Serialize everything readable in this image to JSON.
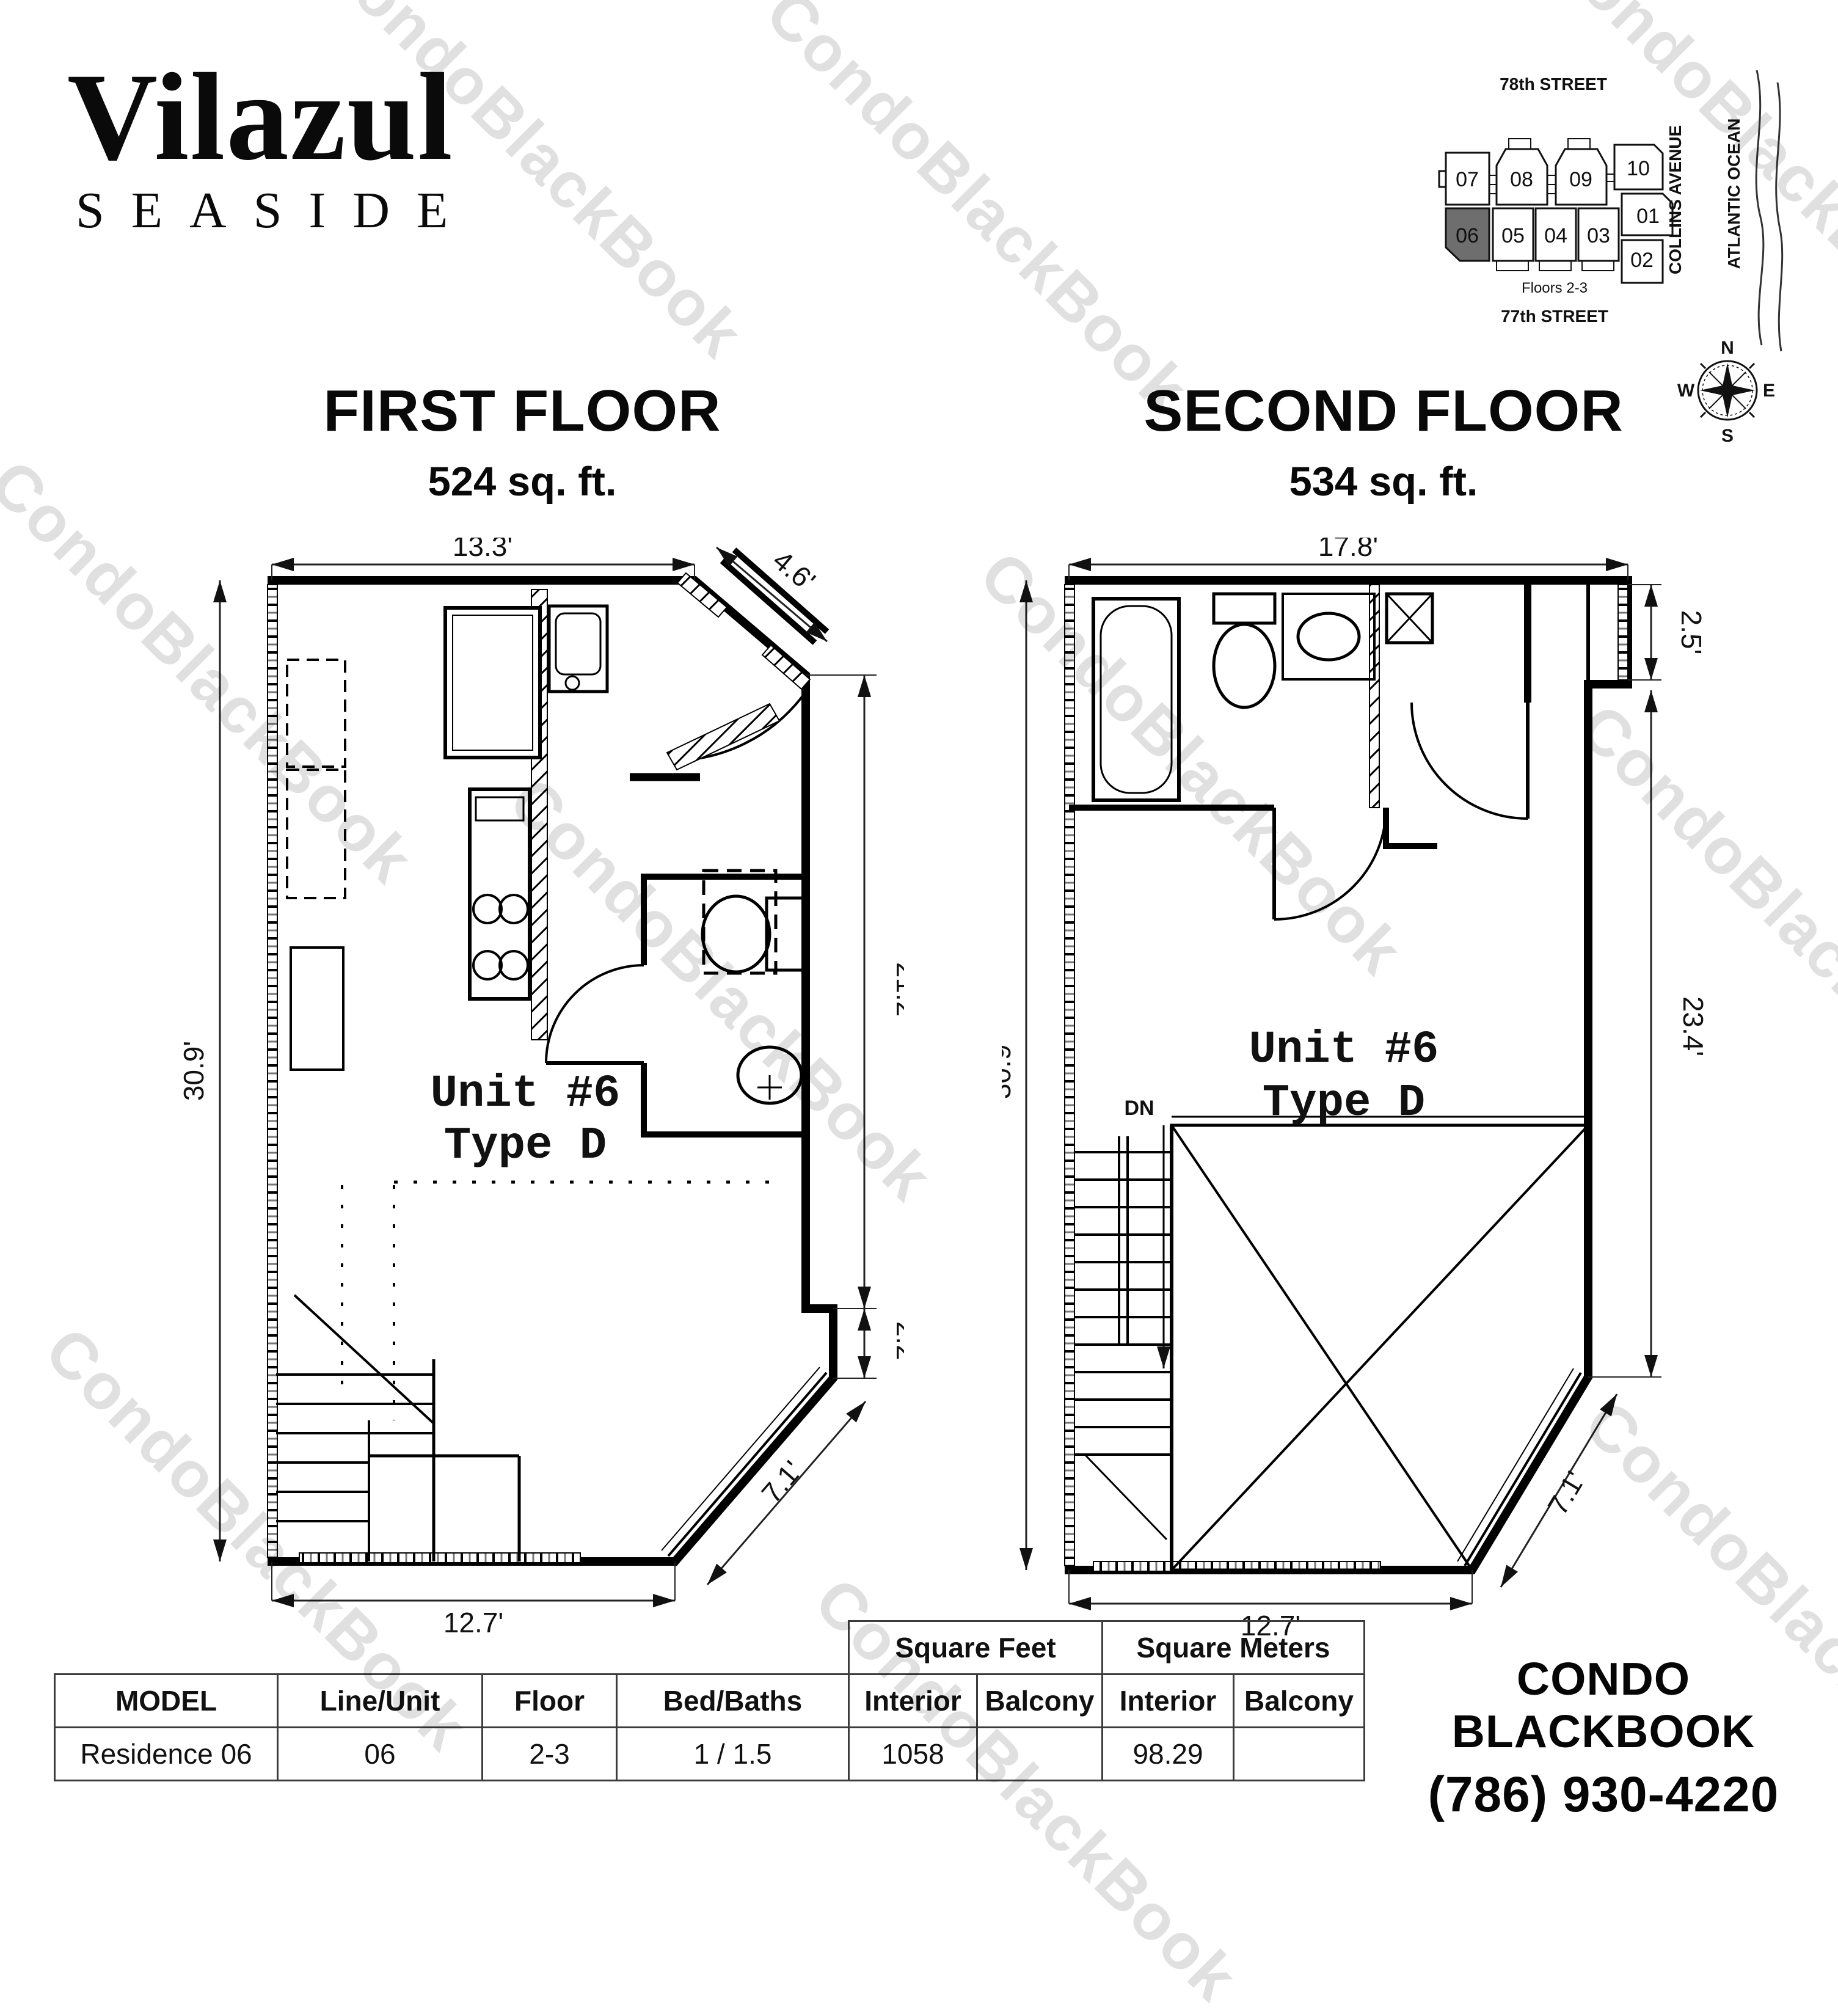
{
  "branding": {
    "logo_line1": "Vilazul",
    "logo_line2": "SEASIDE"
  },
  "site_map": {
    "street_top": "78th STREET",
    "street_bottom": "77th STREET",
    "avenue": "COLLINS AVENUE",
    "ocean": "ATLANTIC OCEAN",
    "floors_note": "Floors 2-3",
    "units_row1": [
      "07",
      "08",
      "09",
      "10"
    ],
    "unit_01": "01",
    "units_row2": [
      "06",
      "05",
      "04",
      "03",
      "02"
    ],
    "highlighted_unit": "06",
    "highlight_color": "#6e6e6e",
    "compass": {
      "n": "N",
      "s": "S",
      "e": "E",
      "w": "W"
    }
  },
  "first_floor": {
    "title": "FIRST FLOOR",
    "area": "524 sq. ft.",
    "unit_line1": "Unit #6",
    "unit_line2": "Type D",
    "dim_top": "13.3'",
    "dim_entry": "4.6'",
    "dim_left": "30.9'",
    "dim_right": "21.2'",
    "dim_step": "2.2'",
    "dim_chamfer": "7.1'",
    "dim_bottom": "12.7'"
  },
  "second_floor": {
    "title": "SECOND FLOOR",
    "area": "534 sq. ft.",
    "unit_line1": "Unit #6",
    "unit_line2": "Type D",
    "dim_top": "17.8'",
    "dim_notch": "2.5'",
    "dim_left": "30.9'",
    "dim_right": "23.4'",
    "dim_chamfer": "7.1'",
    "dim_bottom": "12.7'",
    "stair_label": "DN"
  },
  "table": {
    "group_headers": {
      "sqft": "Square Feet",
      "sqm": "Square Meters"
    },
    "columns": [
      "MODEL",
      "Line/Unit",
      "Floor",
      "Bed/Baths",
      "Interior",
      "Balcony",
      "Interior",
      "Balcony"
    ],
    "row": {
      "model": "Residence 06",
      "line_unit": "06",
      "floor": "2-3",
      "bed_baths": "1 / 1.5",
      "sqft_interior": "1058",
      "sqft_balcony": "",
      "sqm_interior": "98.29",
      "sqm_balcony": ""
    }
  },
  "contact": {
    "name": "CONDO BLACKBOOK",
    "phone": "(786) 930-4220"
  },
  "watermark": {
    "text": "CondoBlackBook"
  }
}
